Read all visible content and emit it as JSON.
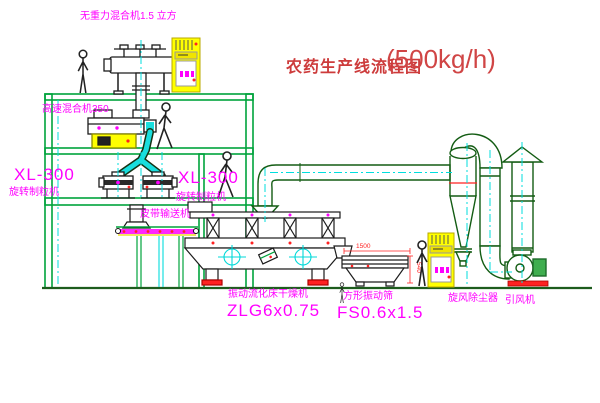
{
  "title": {
    "text": "农药生产线流程图",
    "capacity": "(500kg/h)"
  },
  "labels": {
    "gravity_mixer": "无重力混合机1.5 立方",
    "high_speed_mixer": "高速混合机350",
    "granulator_left_model": "XL-300",
    "granulator_left_name": "旋转制粒机",
    "granulator_right_model": "XL-300",
    "granulator_right_name": "旋转制粒机",
    "belt_conveyor": "皮带输送机",
    "dryer_name": "振动流化床干燥机",
    "dryer_model": "ZLG6x0.75",
    "sieve_name": "方形振动筛",
    "sieve_model": "FS0.6x1.5",
    "cyclone": "旋风除尘器",
    "fan": "引风机"
  },
  "dimensions": {
    "sieve_length": "1500",
    "sieve_height": "540"
  },
  "colors": {
    "structure_green": "#00a33c",
    "duct_green": "#135c13",
    "centerline_cyan": "#00dede",
    "label_magenta": "#ff00ff",
    "title_red": "#cd3b3b",
    "accent_red": "#ff2222",
    "cabinet_yellow": "#ffff00",
    "machine_black": "#1c1c1c"
  }
}
